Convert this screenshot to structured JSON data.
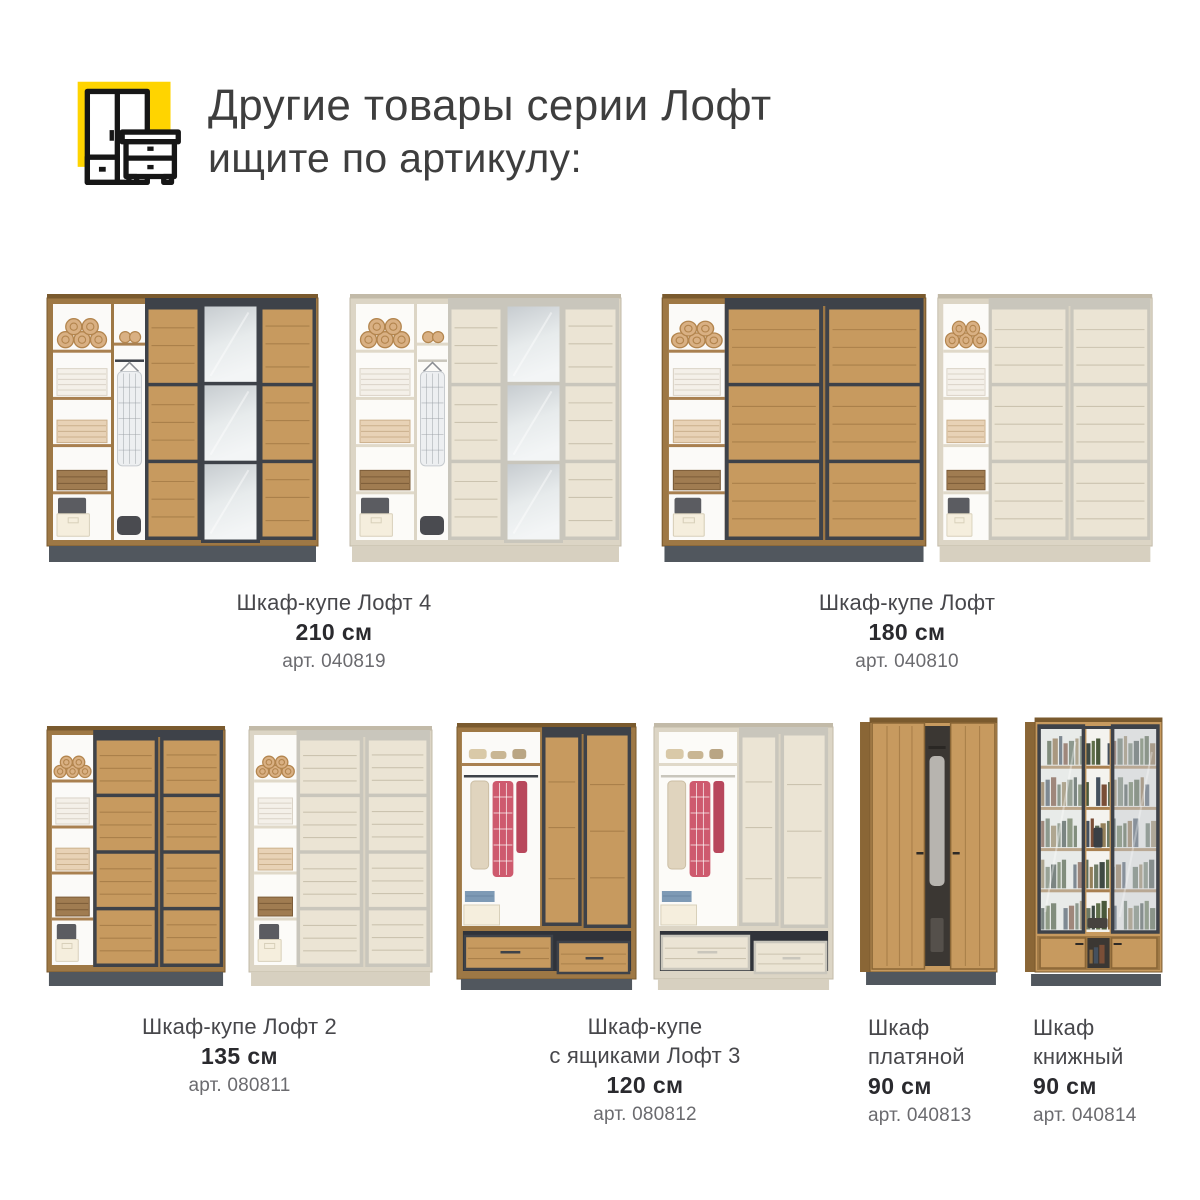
{
  "header": {
    "title": "Другие товары серии Лофт",
    "subtitle": "ищите по артикулу:",
    "icon": {
      "name": "wardrobe-nightstand-icon",
      "accent_color": "#FFD400",
      "outline_color": "#161616"
    }
  },
  "products": [
    {
      "name": "Шкаф-купе Лофт 4",
      "size": "210 см",
      "article": "арт. 040819",
      "images": [
        "wardrobe-sliding-3door-mirror-oak",
        "wardrobe-sliding-3door-mirror-light"
      ]
    },
    {
      "name": "Шкаф-купе Лофт",
      "size": "180 см",
      "article": "арт. 040810",
      "images": [
        "wardrobe-sliding-2door-oak",
        "wardrobe-sliding-2door-light"
      ]
    },
    {
      "name": "Шкаф-купе Лофт 2",
      "size": "135 см",
      "article": "арт. 080811",
      "images": [
        "wardrobe-sliding-narrow-oak",
        "wardrobe-sliding-narrow-light"
      ]
    },
    {
      "name": "Шкаф-купе\nс ящиками Лофт 3",
      "size": "120 см",
      "article": "арт. 080812",
      "images": [
        "wardrobe-drawers-oak",
        "wardrobe-drawers-light"
      ]
    },
    {
      "name": "Шкаф\nплатяной",
      "size": "90 см",
      "article": "арт. 040813",
      "images": [
        "wardrobe-hinged-2door-oak"
      ]
    },
    {
      "name": "Шкаф\nкнижный",
      "size": "90 см",
      "article": "арт. 040814",
      "images": [
        "bookcase-glass-doors-oak"
      ]
    }
  ],
  "palette": {
    "accent_yellow": "#FFD400",
    "icon_outline": "#161616",
    "title_text": "#3E3E3E",
    "name_text": "#47474B",
    "size_text": "#2A2A2E",
    "article_text": "#6B6B6F",
    "oak_wood": "#C79A5F",
    "oak_carcass": "#9E7845",
    "oak_edge": "#7A5A2E",
    "dark_frame": "#3E4249",
    "dark_plinth": "#51575E",
    "light_wood": "#EBE4D4",
    "light_carcass": "#DCD5C5",
    "light_frame": "#C9C6BC",
    "light_plinth": "#D7D0C0",
    "mirror_top": "#C7CCD0",
    "mirror_bottom": "#F3F5F6"
  }
}
